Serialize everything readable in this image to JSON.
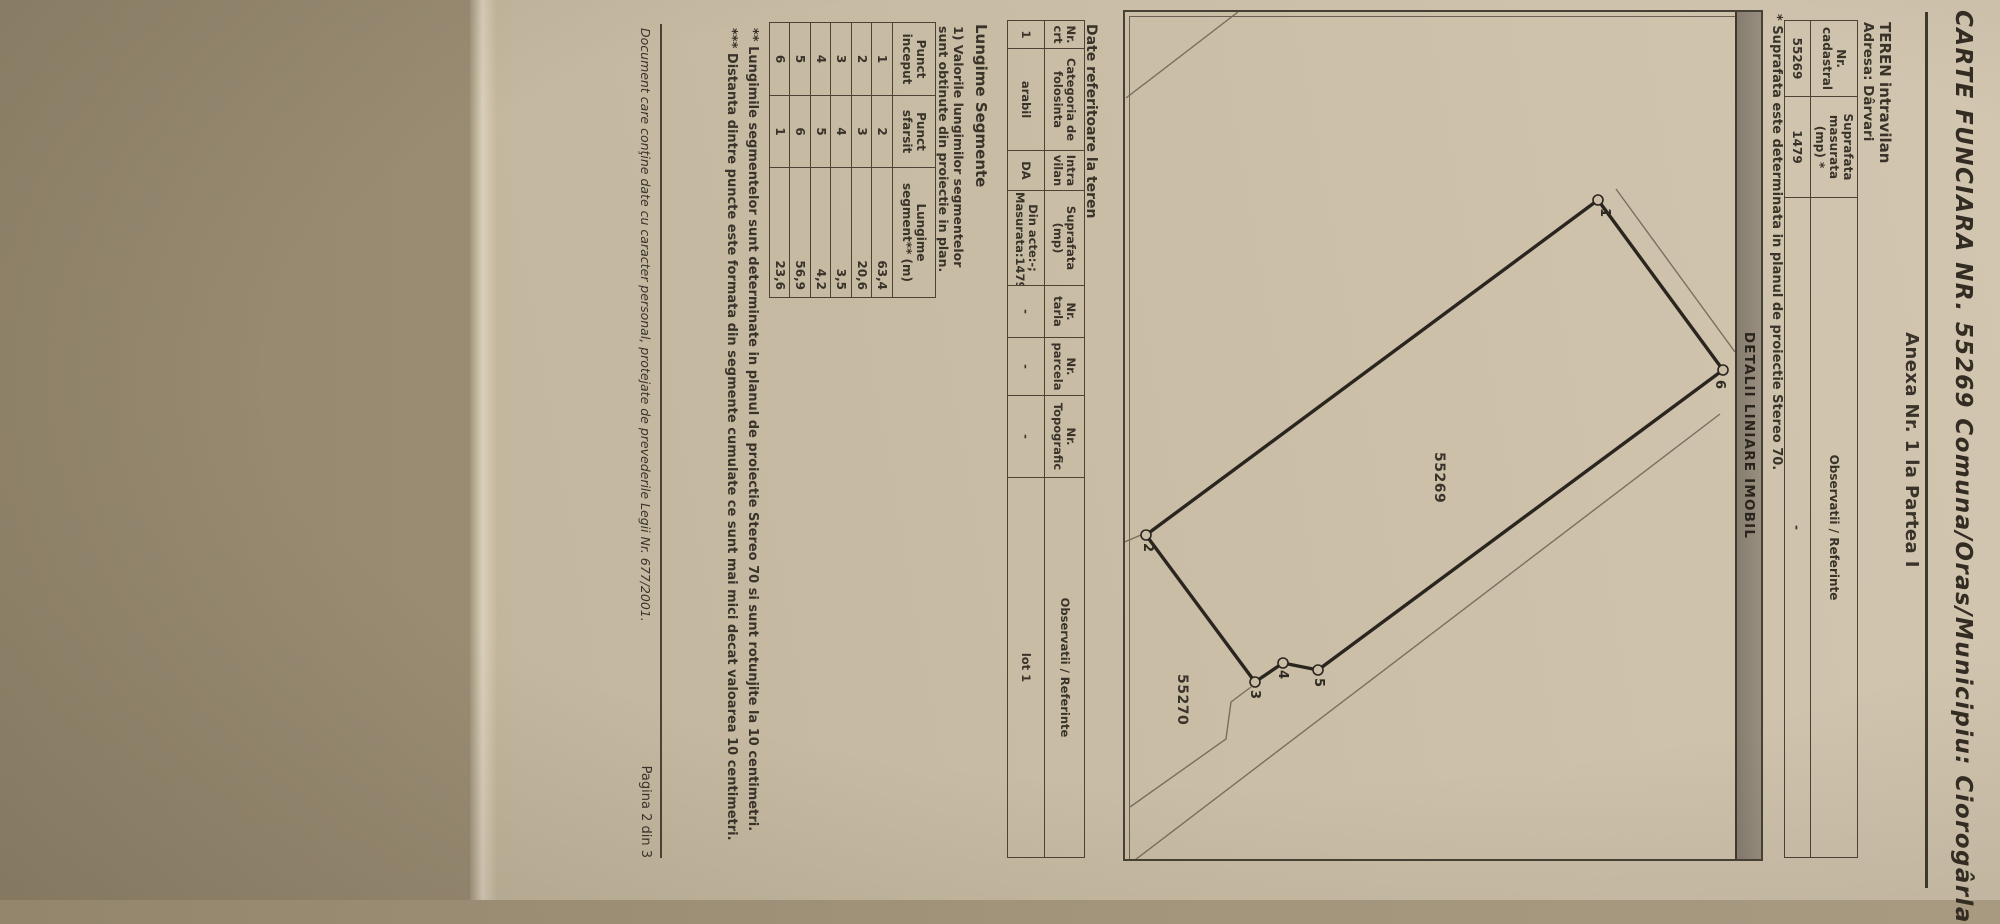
{
  "colors": {
    "paper": "#cbbfa8",
    "ink": "#3a332a",
    "bar_gray": "#8e8577",
    "background": "#a3957c"
  },
  "header": {
    "title": "CARTE FUNCIARA NR. 55269 Comuna/Oras/Municipiu: Ciorogârla",
    "annex": "Anexa Nr. 1 la Partea I"
  },
  "teren": {
    "heading": "TEREN intravilan",
    "address": "Adresa: Dârvari",
    "table": {
      "col1": "Nr. cadastral",
      "col2": "Suprafata masurata (mp) *",
      "col3": "Observatii / Referinte",
      "row": [
        "55269",
        "1479",
        "-"
      ]
    },
    "footnote": "* Suprafata este determinata in planul de proiectie Stereo 70."
  },
  "plan": {
    "title": "DETALII LINIARE IMOBIL",
    "parcel_label": "55269",
    "neighbor_label": "55270",
    "points": [
      "1",
      "2",
      "3",
      "4",
      "5",
      "6"
    ]
  },
  "date_teren": {
    "title": "Date referitoare la teren",
    "headers": [
      "Nr. crt",
      "Categoria de folosinta",
      "Intra vilan",
      "Suprafata (mp)",
      "Nr. tarla",
      "Nr. parcela",
      "Nr. Topografic",
      "Observatii / Referinte"
    ],
    "row": [
      "1",
      "arabil",
      "DA",
      "Din acte:-; Masurata:1479",
      "-",
      "-",
      "-",
      "lot 1"
    ]
  },
  "segments": {
    "title": "Lungime Segmente",
    "note_line1": "1) Valorile lungimilor segmentelor",
    "note_line2": "sunt obtinute din proiectie in plan.",
    "headers": [
      "Punct inceput",
      "Punct sfarsit",
      "Lungime segment** (m)"
    ],
    "rows": [
      [
        "1",
        "2",
        "63,4"
      ],
      [
        "2",
        "3",
        "20,6"
      ],
      [
        "3",
        "4",
        "3,5"
      ],
      [
        "4",
        "5",
        "4,2"
      ],
      [
        "5",
        "6",
        "56,9"
      ],
      [
        "6",
        "1",
        "23,6"
      ]
    ],
    "footnote2": "** Lungimile segmentelor sunt determinate in planul de proiectie Stereo 70 si sunt rotunjite la 10 centimetri.",
    "footnote3": "*** Distanta dintre puncte este formata din segmente cumulate ce sunt mai mici decat valoarea 10 centimetri."
  },
  "footer": {
    "notice": "Document care conţine date cu caracter personal, protejate de prevederile Legii Nr. 677/2001.",
    "page": "Pagina 2 din 3"
  }
}
